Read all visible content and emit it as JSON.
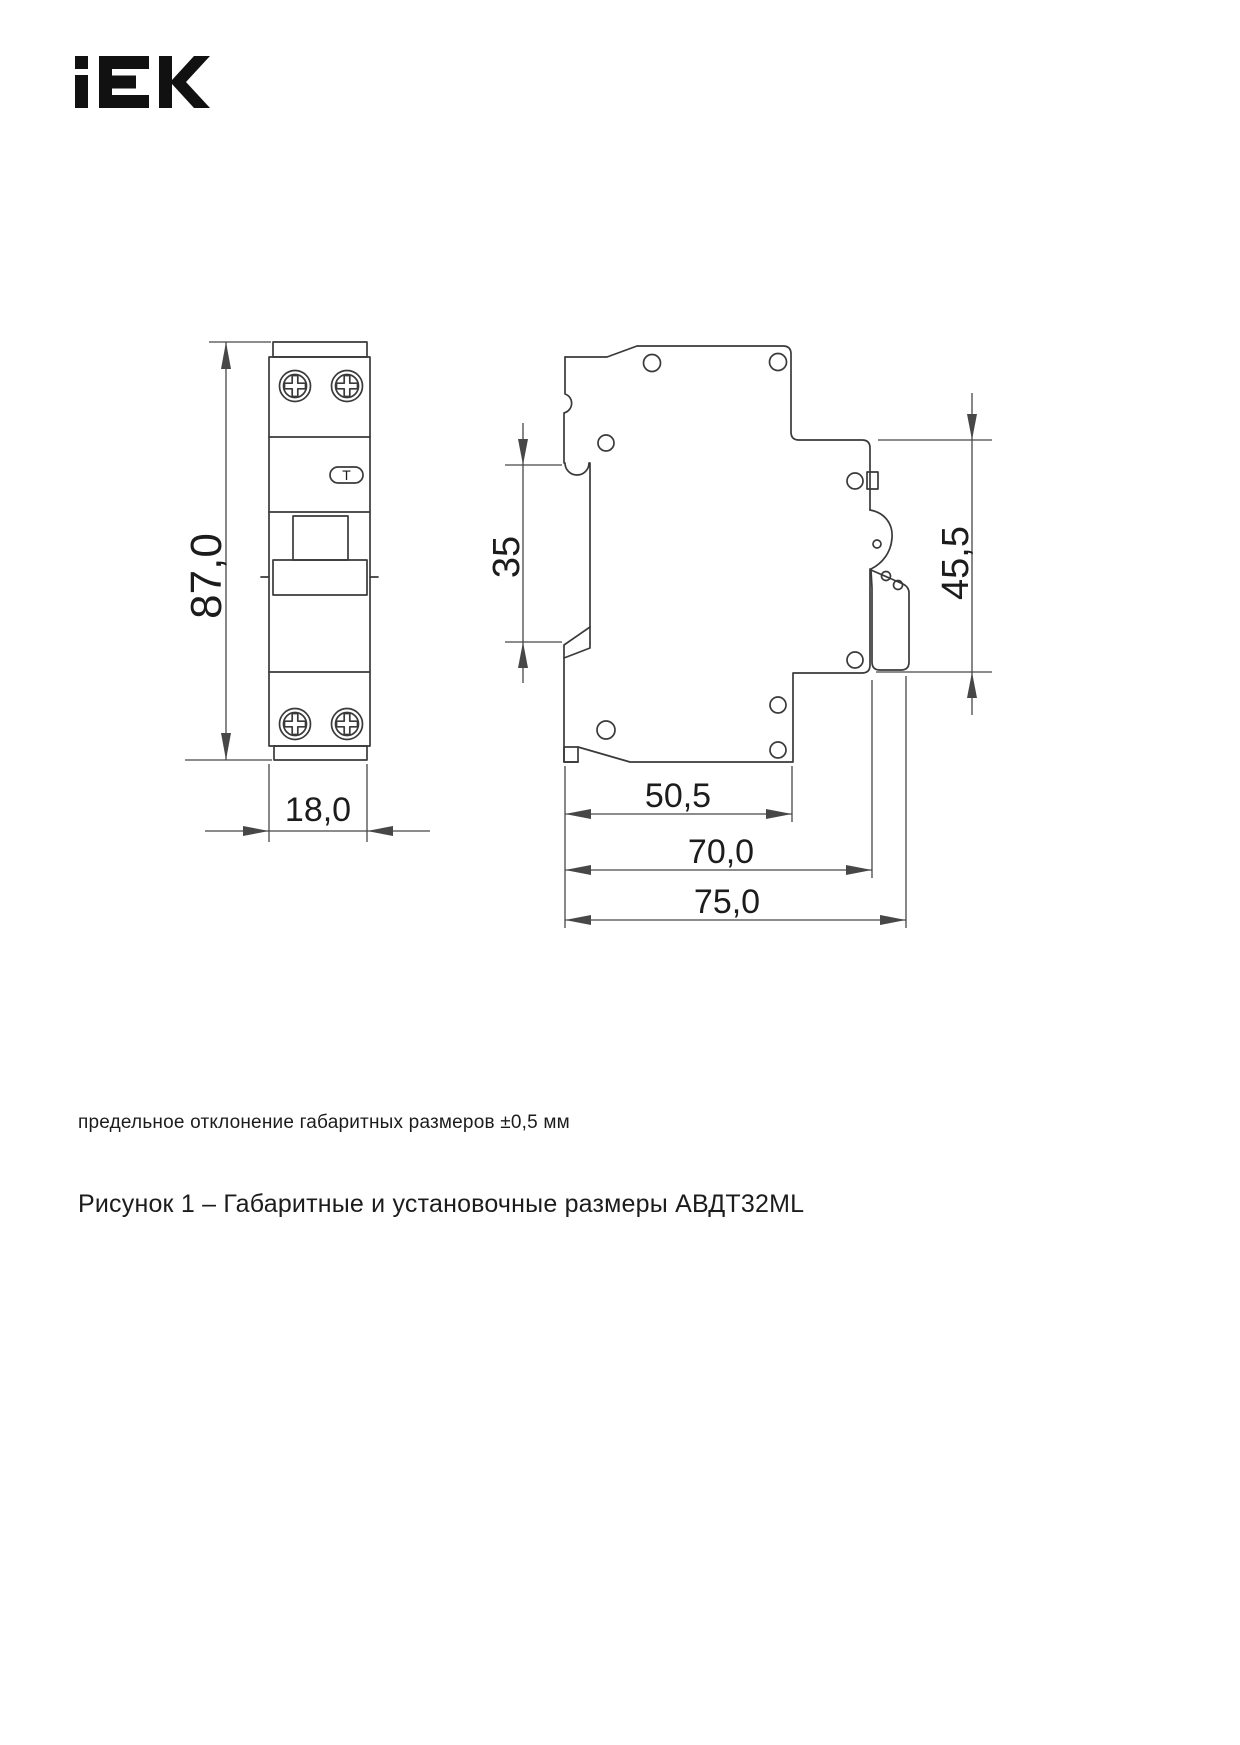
{
  "logo": {
    "brand": "IEK"
  },
  "page": {
    "note": "предельное отклонение габаритных размеров ±0,5 мм",
    "caption": "Рисунок 1 – Габаритные и установочные размеры АВДТ32ML"
  },
  "drawing": {
    "front_view": {
      "height": "87,0",
      "width": "18,0",
      "test_button": "Т"
    },
    "side_view": {
      "din_slot": "35",
      "rear_height": "45,5",
      "body_depth": "50,5",
      "mid_depth": "70,0",
      "total_depth": "75,0"
    }
  }
}
